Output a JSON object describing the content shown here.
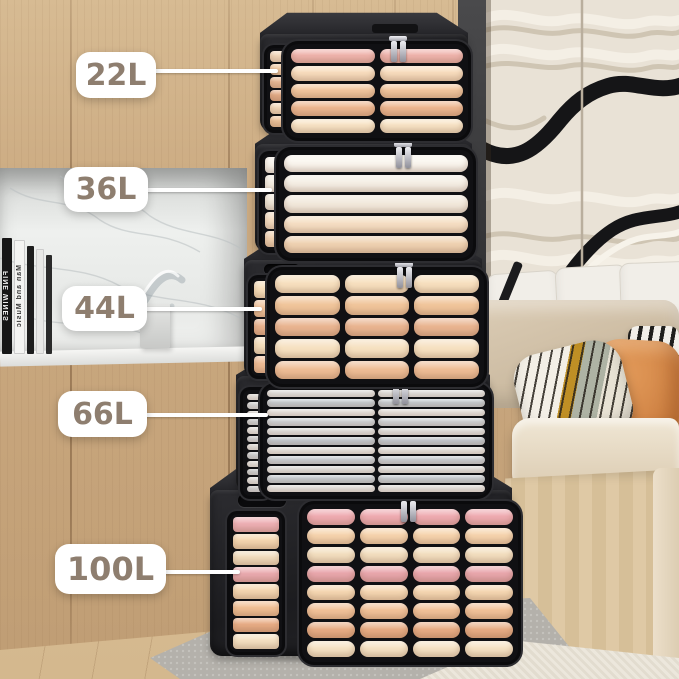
{
  "labels": [
    {
      "id": "22l",
      "text": "22L"
    },
    {
      "id": "36l",
      "text": "36L"
    },
    {
      "id": "44l",
      "text": "44L"
    },
    {
      "id": "66l",
      "text": "66L"
    },
    {
      "id": "100l",
      "text": "100L"
    }
  ],
  "books": [
    {
      "title": "FINE WINES"
    },
    {
      "title": "Man and Music"
    }
  ],
  "palette": {
    "wood-wall": "#c9a87f",
    "wood-seam": "#6e4e30",
    "box-black": "#202023",
    "marble": "#eceeec",
    "label-bg": "#ffffff",
    "label-text": "#8e7e6f",
    "leader-line": "#ffffff",
    "wavy-cream": "#e9e2d6",
    "wavy-black": "#151517",
    "floor-wood": "#d9bf98",
    "rug-gray": "#b4b1ab",
    "carpet-cream": "#e9e4d8",
    "sofa-beige": "#d8c8b0",
    "pillow-orange": "#d5894b",
    "zipper-silver": "#c9cad1"
  },
  "boxes": [
    {
      "capacity": "22L",
      "front": {
        "columns": 2,
        "rows": [
          "#f0b5ae",
          "#f8ddbe",
          "#f2c79f",
          "#edb791",
          "#f8e4c6"
        ]
      },
      "side": {
        "columns": 1,
        "rows": [
          "#f6dcc0",
          "#f2cba4",
          "#ecbd99",
          "#e7b08b",
          "#f5dcbf",
          "#efc69e"
        ]
      }
    },
    {
      "capacity": "36L",
      "front": {
        "columns": 1,
        "rows": [
          "#faf6ef",
          "#f5efe5",
          "#f2e9dc",
          "#f5dec3",
          "#efd2b2"
        ]
      },
      "side": {
        "columns": 1,
        "rows": [
          "#f8f4ec",
          "#f3ede2",
          "#efe7d9",
          "#f4ddc2",
          "#eed0b0"
        ]
      }
    },
    {
      "capacity": "44L",
      "front": {
        "columns": 3,
        "rows": [
          "#f7e0bf",
          "#f0c59b",
          "#e9b591",
          "#f6e1c1",
          "#eebd96"
        ]
      },
      "side": {
        "columns": 1,
        "rows": [
          "#f6deba",
          "#efc29a",
          "#e8b28e",
          "#f5dfbe",
          "#edbb94"
        ]
      }
    },
    {
      "capacity": "66L",
      "front": {
        "columns": 2,
        "rows": [
          "#eef0ef",
          "#ccd6dd",
          "#f3f3f1",
          "#d6dee4",
          "#ebeeee",
          "#c8d2da",
          "#f2f2f0",
          "#d2dae1",
          "#edefee",
          "#cdd7de",
          "#f1f1ef"
        ]
      },
      "side": {
        "columns": 1,
        "rows": [
          "#f2f3f2",
          "#dde3e7",
          "#eff1f0",
          "#d7dfe4",
          "#f1f2f1",
          "#dae0e5",
          "#eef0ef",
          "#d5dde2",
          "#f0f1f0",
          "#d8e0e4",
          "#edefee",
          "#dbe1e5"
        ]
      }
    },
    {
      "capacity": "100L",
      "front": {
        "columns": 4,
        "rows": [
          "#efacb2",
          "#f6d4ae",
          "#f3dfc0",
          "#e9a7ad",
          "#f6d8b3",
          "#f2c299",
          "#e8ad85",
          "#f6e3c5"
        ]
      },
      "side": {
        "columns": 1,
        "rows": [
          "#eeb0b5",
          "#f5d6b0",
          "#f2ddbe",
          "#eaabb0",
          "#f5d7b2",
          "#f1c095",
          "#e9ae87",
          "#f5e1c2"
        ]
      }
    }
  ]
}
